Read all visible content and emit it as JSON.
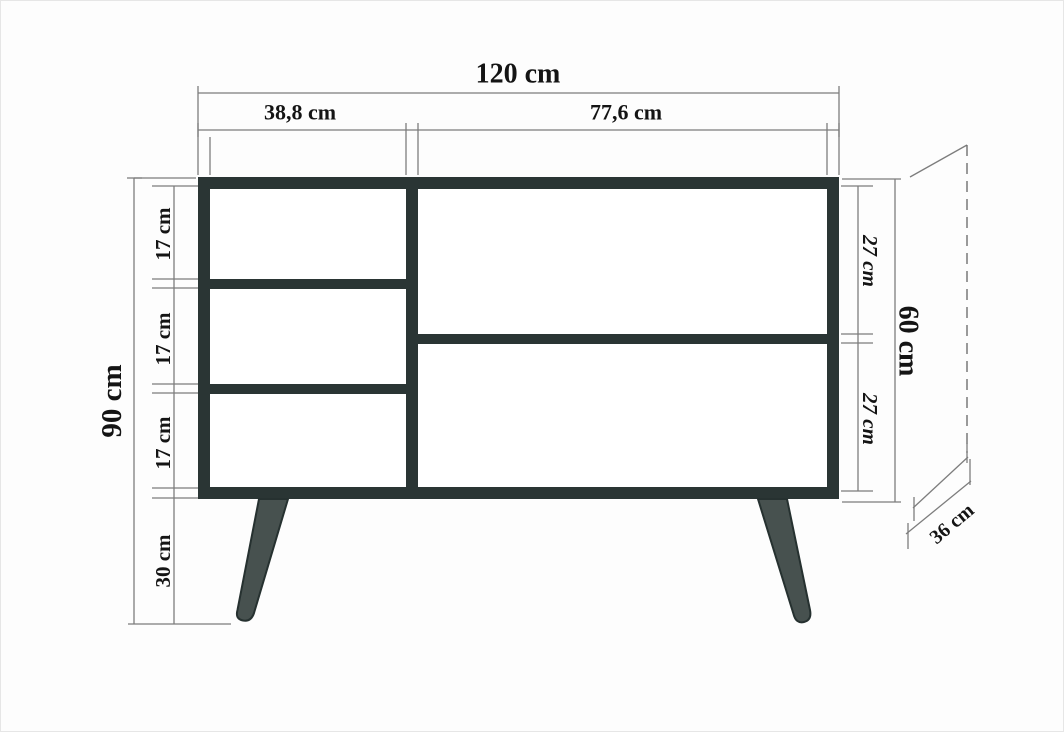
{
  "drawing": {
    "kind": "furniture-dimension-diagram",
    "subject": "sideboard-front-elevation",
    "units": "cm"
  },
  "dimensions": {
    "total_width": "120 cm",
    "left_column_width": "38,8 cm",
    "right_column_width": "77,6 cm",
    "total_height": "90 cm",
    "left_compartment_1": "17 cm",
    "left_compartment_2": "17 cm",
    "left_compartment_3": "17 cm",
    "leg_height": "30 cm",
    "right_compartment_top": "27 cm",
    "right_compartment_bottom": "27 cm",
    "carcass_height": "60 cm",
    "depth": "36 cm"
  },
  "colors": {
    "cabinet_frame": "#2a3534",
    "legs": "#47514f",
    "dimension_lines": "#7d7d7d",
    "text": "#141414",
    "background": "#fdfdfd"
  }
}
